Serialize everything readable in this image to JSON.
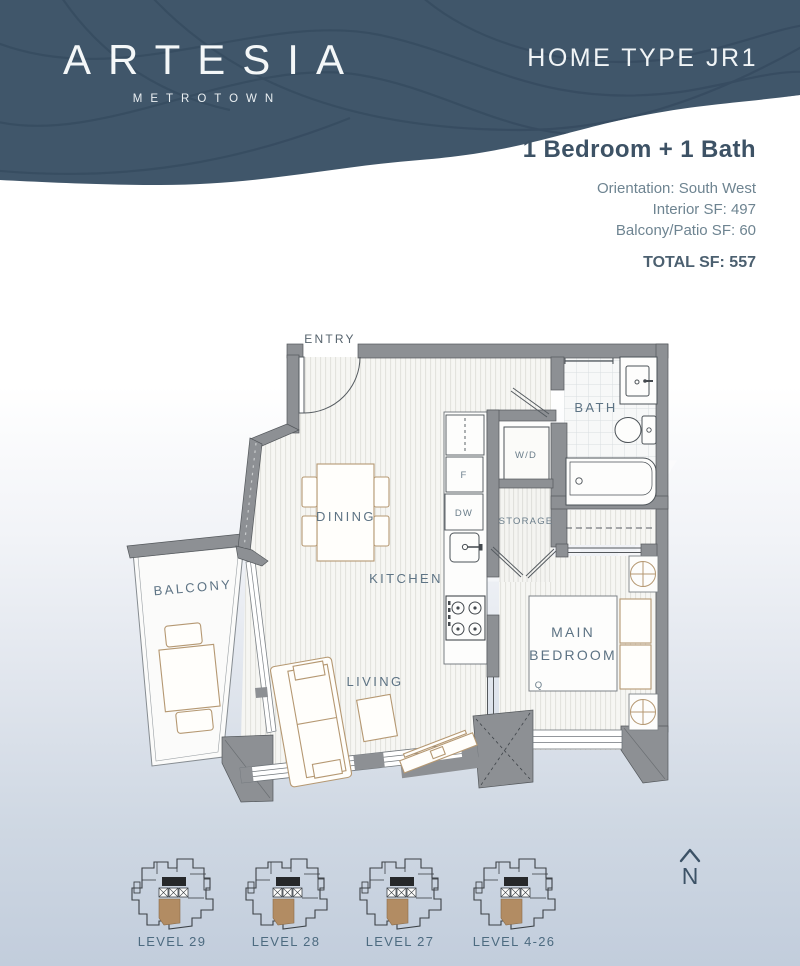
{
  "header": {
    "logo_title": "ARTESIA",
    "logo_subtitle": "METROTOWN",
    "home_type": "HOME TYPE JR1",
    "colors": {
      "header_bg": "#40566a",
      "wave_line": "#31465a",
      "text": "#f4f7f8"
    }
  },
  "summary": {
    "headline": "1 Bedroom + 1 Bath",
    "orientation": "Orientation: South West",
    "interior_sf": "Interior SF: 497",
    "balcony_sf": "Balcony/Patio SF: 60",
    "total_sf": "TOTAL SF: 557"
  },
  "floorplan": {
    "rooms": {
      "entry": "ENTRY",
      "bath": "BATH",
      "dining": "DINING",
      "kitchen": "KITCHEN",
      "living": "LIVING",
      "balcony": "BALCONY",
      "storage": "STORAGE",
      "washer_dryer": "W/D",
      "fridge": "F",
      "dishwasher": "DW",
      "main_bedroom_line1": "MAIN",
      "main_bedroom_line2": "BEDROOM",
      "bed_size": "Q"
    },
    "watermark": {
      "line1": "VANSKY",
      "line2": "温哥华天空"
    },
    "north_label": "N",
    "colors": {
      "label": "#5d7384",
      "wall": "#8d9094",
      "furniture_outline": "#b59872",
      "unit_highlight": "#b28c63"
    }
  },
  "key_plans": [
    {
      "label": "LEVEL 29"
    },
    {
      "label": "LEVEL 28"
    },
    {
      "label": "LEVEL 27"
    },
    {
      "label": "LEVEL 4-26"
    }
  ]
}
